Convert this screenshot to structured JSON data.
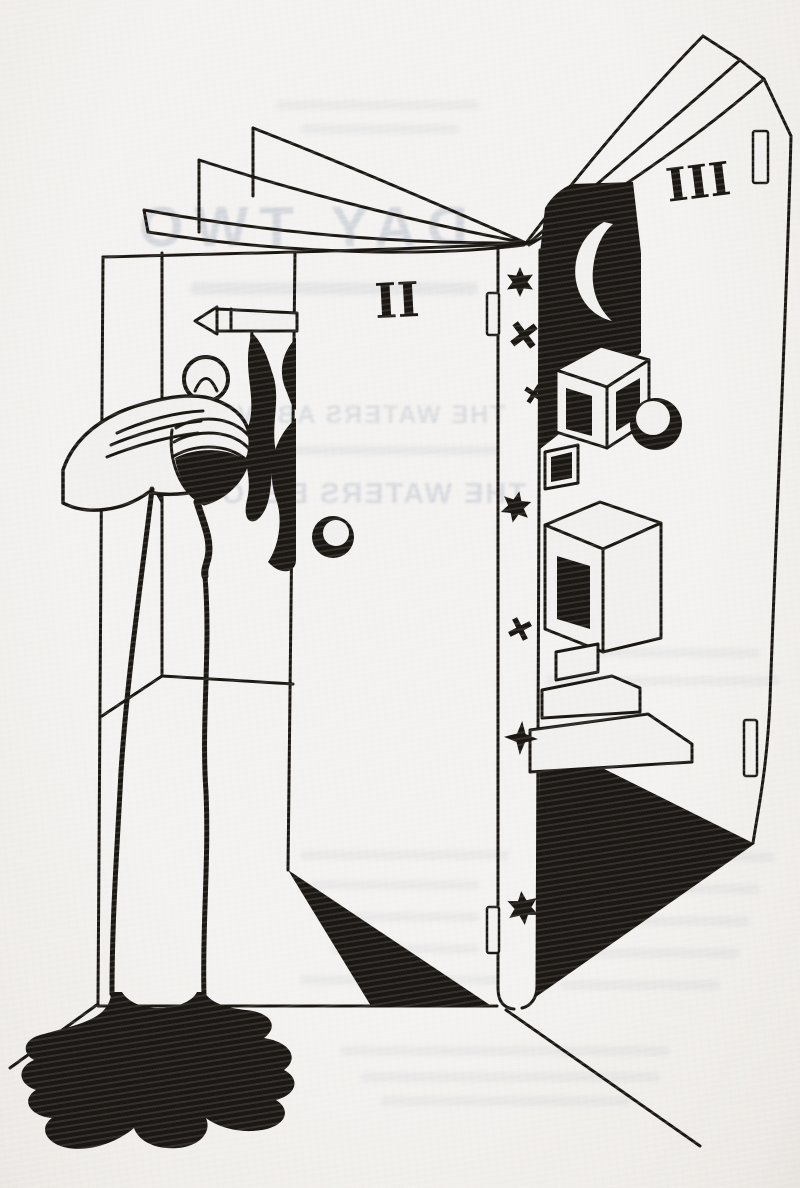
{
  "page": {
    "paper_color": "#f2f0ee",
    "ink_color": "#1b1713",
    "ghost_ink_color": "#9fabbc"
  },
  "ghost_text": {
    "mirrored": true,
    "chapter_heading": "DAY TWO",
    "subtitle_line1": "THE WATERS ABOVE",
    "subtitle_line2": "THE WATERS BELOW"
  },
  "illustration": {
    "middle_page_numeral": "II",
    "right_page_numeral": "III",
    "icons": {
      "crescent-moon": "☾",
      "six-pointed-star": "✶",
      "cross-star": "✕",
      "four-pointed-star": "✦"
    },
    "spine_symbols": [
      {
        "type": "six-pointed-star",
        "x": 520,
        "y": 282,
        "size": 30,
        "rot": 0
      },
      {
        "type": "cross-star",
        "x": 524,
        "y": 335,
        "size": 32,
        "rot": 8
      },
      {
        "type": "cross-star",
        "x": 534,
        "y": 394,
        "size": 22,
        "rot": -12
      },
      {
        "type": "six-pointed-star",
        "x": 516,
        "y": 507,
        "size": 32,
        "rot": 12
      },
      {
        "type": "cross-star",
        "x": 520,
        "y": 629,
        "size": 26,
        "rot": 18
      },
      {
        "type": "four-pointed-star",
        "x": 521,
        "y": 738,
        "size": 34,
        "rot": 4
      },
      {
        "type": "six-pointed-star",
        "x": 523,
        "y": 908,
        "size": 34,
        "rot": -6
      }
    ]
  }
}
